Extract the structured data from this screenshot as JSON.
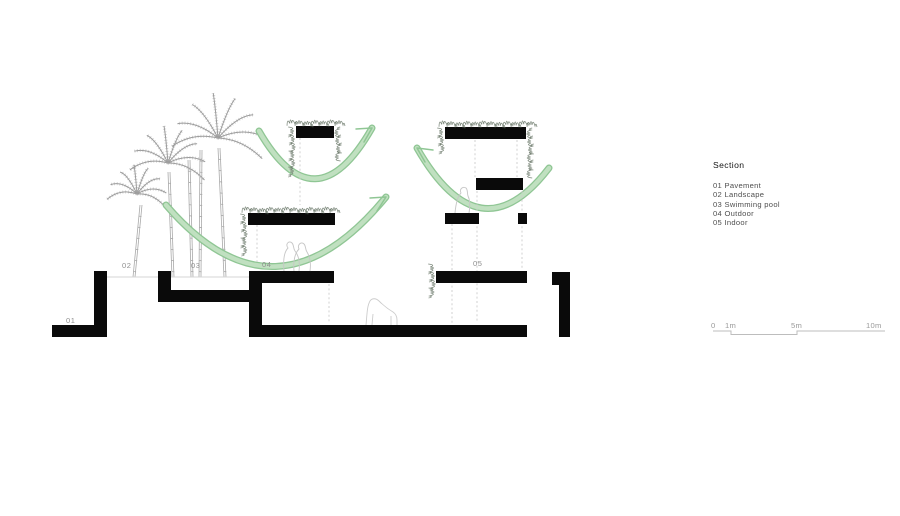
{
  "zones": {
    "z01": "01",
    "z02": "02",
    "z03": "03",
    "z04": "04",
    "z05": "05"
  },
  "legend": {
    "title": "Section",
    "items": [
      "01 Pavement",
      "02 Landscape",
      "03 Swimming pool",
      "04 Outdoor",
      "05 Indoor"
    ]
  },
  "scalebar": {
    "t0": "0",
    "t1": "1m",
    "t2": "5m",
    "t3": "10m"
  },
  "colors": {
    "ink": "#0a0a0a",
    "arc_green_edge": "#8fc694",
    "arc_green_fill": "#c0e0c0",
    "sketch_gray": "#9b9b9b"
  }
}
